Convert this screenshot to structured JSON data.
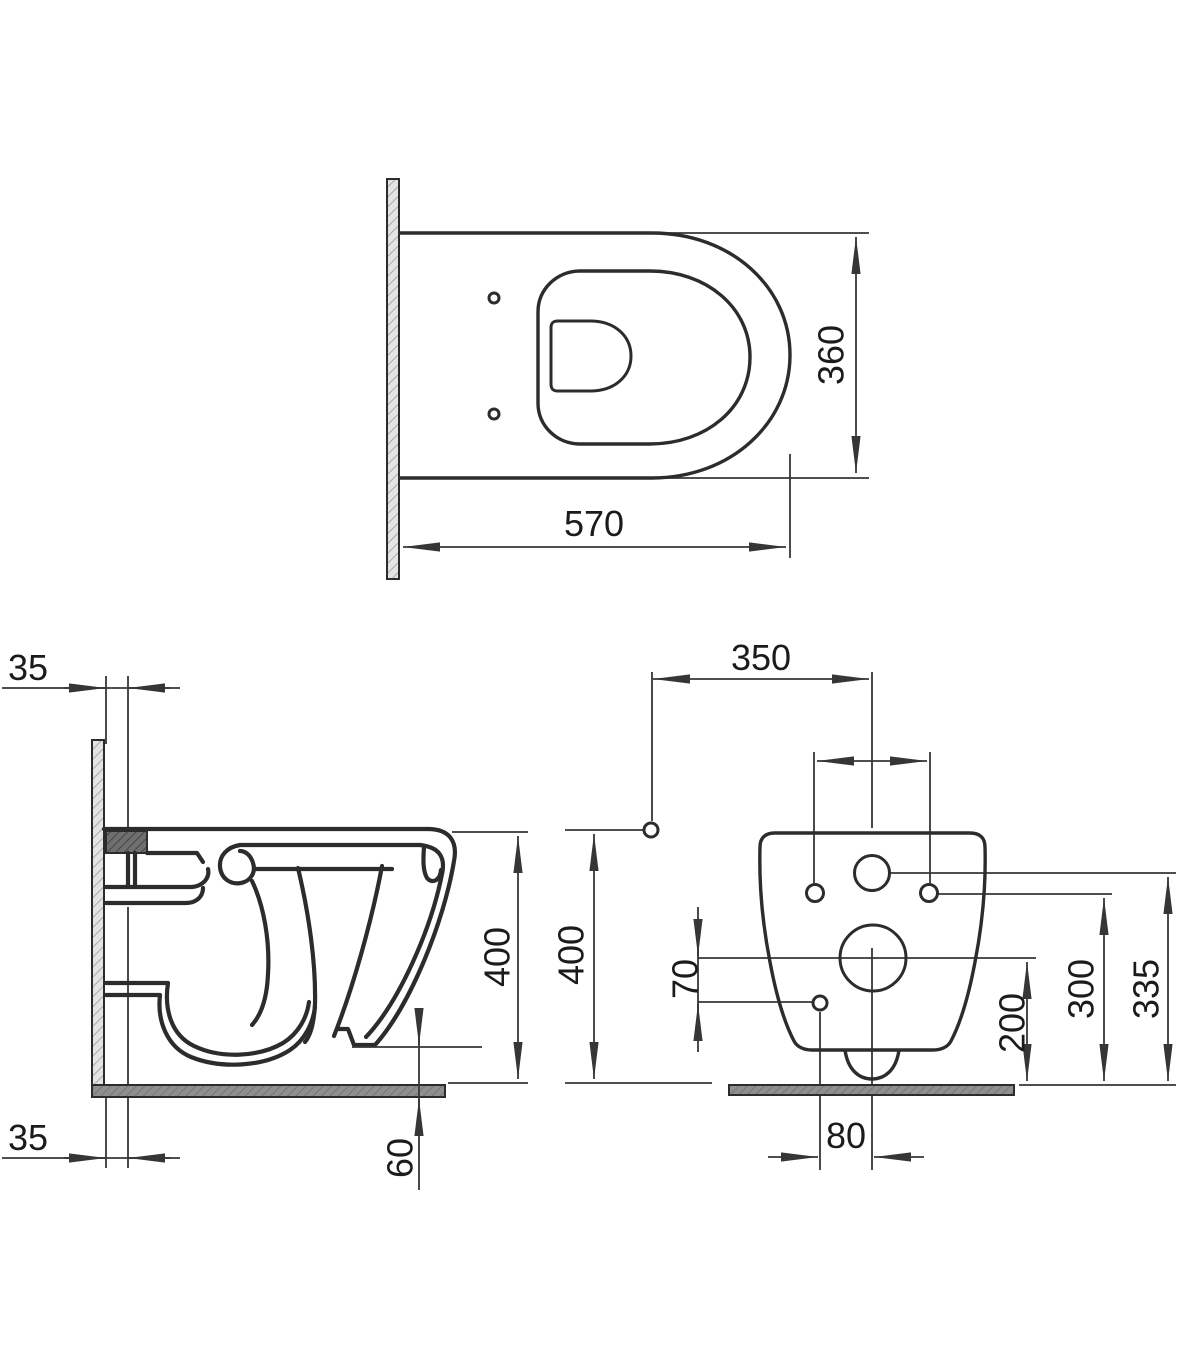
{
  "colors": {
    "line": "#2c2c2c",
    "dim_line": "#363636",
    "text": "#1b1b1b",
    "background": "#ffffff",
    "wall_fill": "#e4e4e4",
    "wall_hatch": "#9b9b9b",
    "floor_fill": "#8f8f8f",
    "floor_hatch": "#6a6a6a",
    "anchor_fill": "#6f6f6f",
    "anchor_hatch": "#3b3b3b"
  },
  "views": {
    "top": {
      "dims": {
        "depth": "570",
        "width": "360"
      }
    },
    "side": {
      "dims": {
        "wall_offset_top": "35",
        "wall_offset_bottom": "35",
        "height": "400",
        "floor_clearance": "60"
      }
    },
    "front": {
      "dims": {
        "inlet_offset": "350",
        "height": "400",
        "hole_drop": "70",
        "drain_height": "200",
        "fixing_height": "300",
        "inlet_height": "335",
        "drain_offset": "80"
      }
    }
  }
}
